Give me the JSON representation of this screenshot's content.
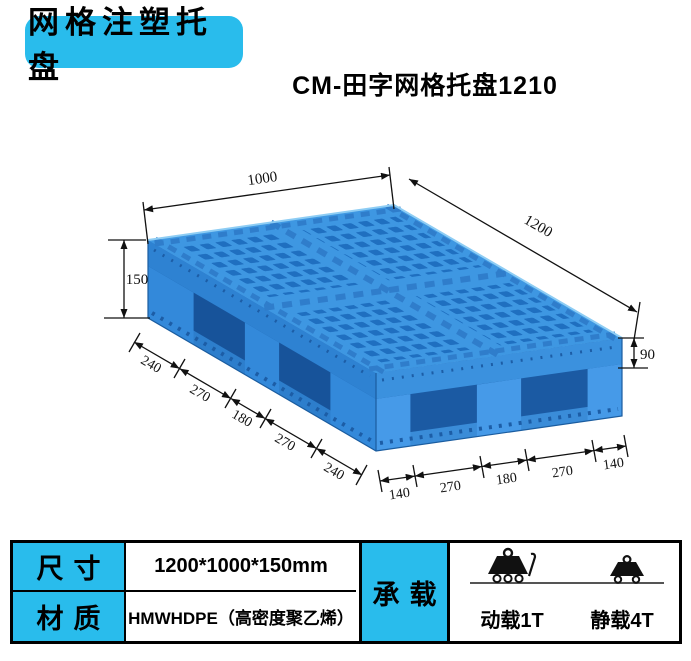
{
  "badge": {
    "label": "网格注塑托盘"
  },
  "header": {
    "title": "CM-田字网格托盘1210"
  },
  "diagram": {
    "dim_width": "1000",
    "dim_length": "1200",
    "dim_height_total": "150",
    "dim_height_deck": "90",
    "left_edge_dims": [
      "240",
      "270",
      "180",
      "270",
      "240"
    ],
    "bottom_edge_dims": [
      "140",
      "270",
      "180",
      "270",
      "140"
    ]
  },
  "spec_table": {
    "size_label": "尺寸",
    "size_value": "1200*1000*150mm",
    "material_label": "材质",
    "material_value": "HMWHDPE（高密度聚乙烯）",
    "load_label": "承载",
    "dynamic_load": "动载1T",
    "static_load": "静载4T"
  },
  "colors": {
    "accent_cyan": "#29bcec",
    "pallet_blue": "#3e97e2"
  }
}
